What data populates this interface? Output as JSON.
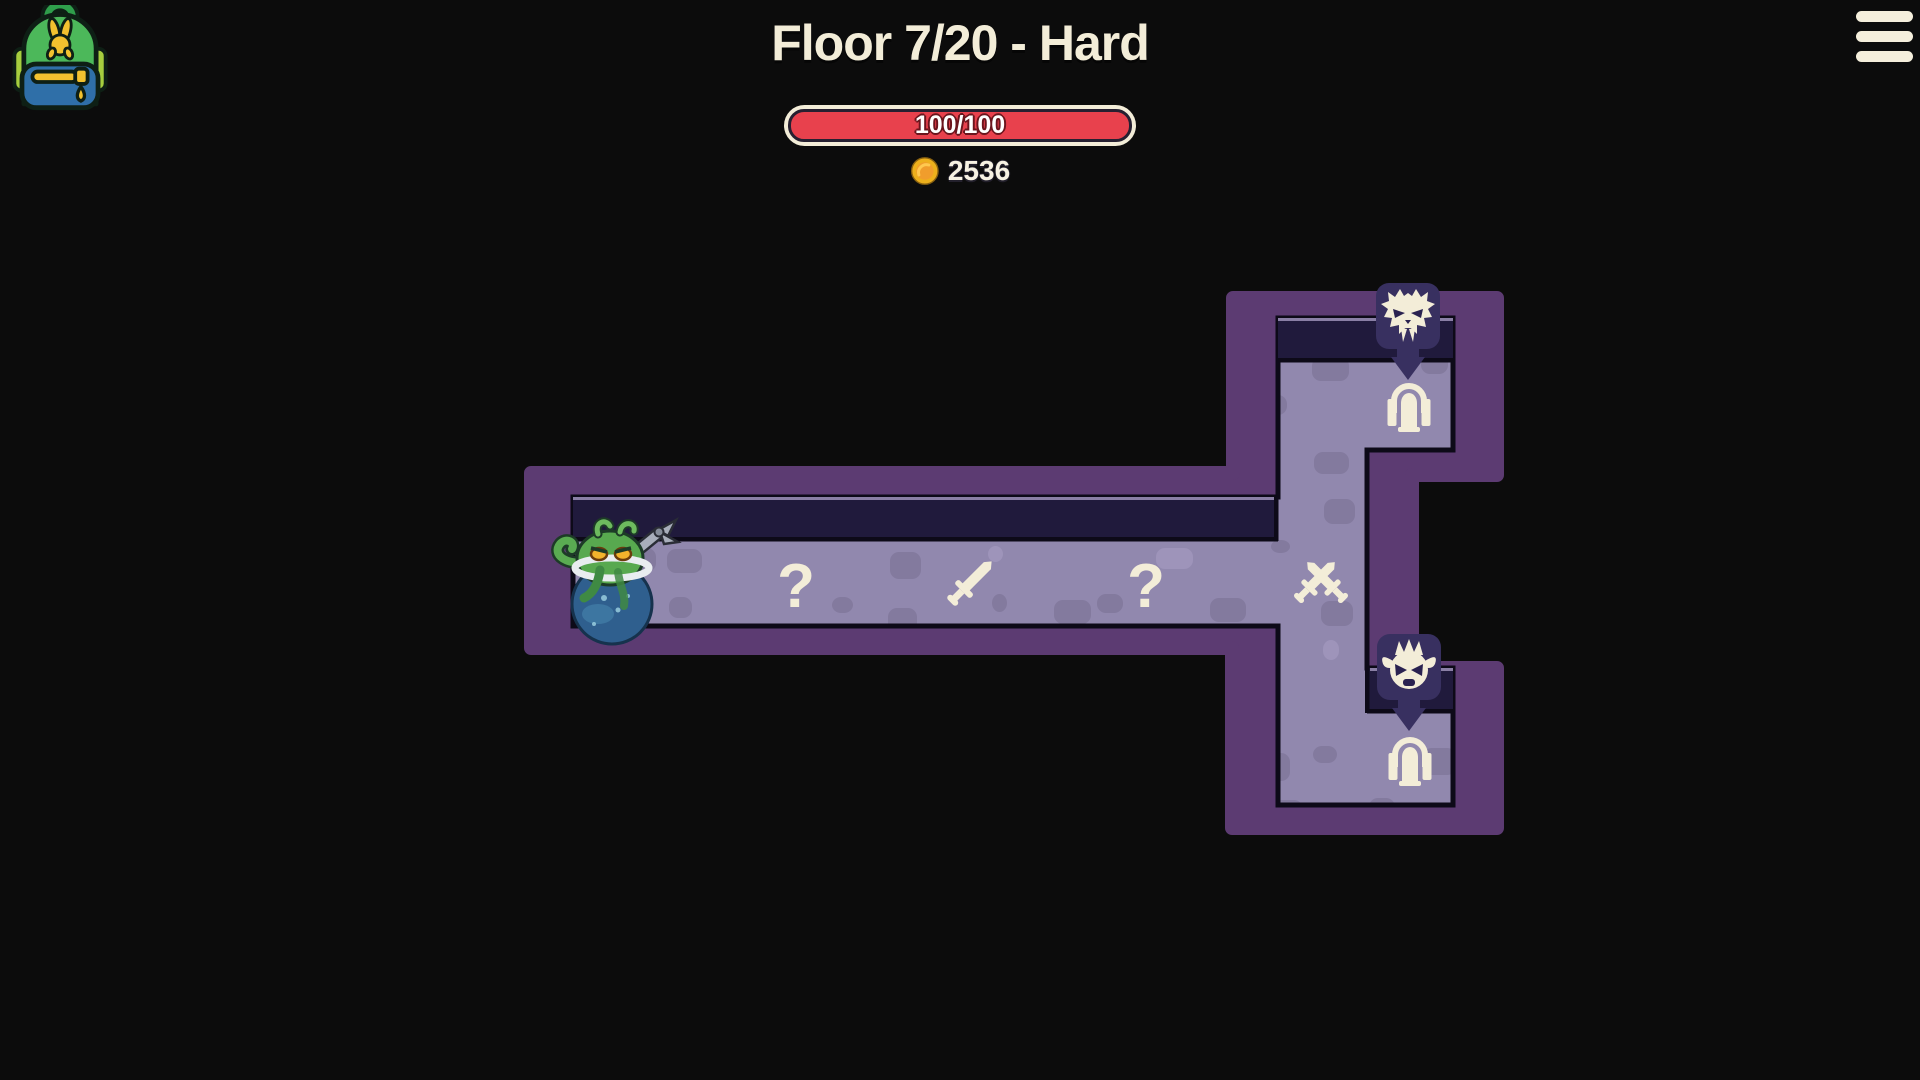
{
  "header": {
    "title": "Floor 7/20 - Hard",
    "health": {
      "current": 100,
      "max": 100,
      "display": "100/100"
    },
    "gold": "2536"
  },
  "hud": {
    "inventory_icon": "backpack-icon",
    "menu_icon": "hamburger-menu-icon",
    "coin_icon": "gold-coin-icon"
  },
  "colors": {
    "background": "#0c0c0c",
    "wall": "#5c3b72",
    "floor": "#9188ae",
    "tile_dark": "#837a9e",
    "tile_light": "#9e94ba",
    "wall_top": "#201a3c",
    "wall_top_highlight": "#8a7fa5",
    "outline": "#0d0a18",
    "cream": "#f3edd8",
    "badge": "#383060",
    "health_red": "#e8414d",
    "coin_gold": "#edb01c",
    "coin_inner": "#f09d2c"
  },
  "map": {
    "nodes": [
      {
        "name": "player-character",
        "icon": "octopus-clawbot",
        "type": "player",
        "x": 612,
        "y": 584
      },
      {
        "name": "node-unknown-1",
        "icon": "question-mark",
        "type": "unknown",
        "x": 796,
        "y": 585
      },
      {
        "name": "node-item-sword",
        "icon": "sword",
        "type": "item",
        "x": 969,
        "y": 584
      },
      {
        "name": "node-unknown-2",
        "icon": "question-mark",
        "type": "unknown",
        "x": 1146,
        "y": 585
      },
      {
        "name": "node-battle",
        "icon": "crossed-swords",
        "type": "battle",
        "x": 1321,
        "y": 583
      },
      {
        "name": "exit-door-top",
        "icon": "door",
        "type": "exit",
        "x": 1409,
        "y": 403,
        "badge": {
          "icon": "horned-beast-face",
          "x": 1408,
          "y": 316
        }
      },
      {
        "name": "exit-door-bottom",
        "icon": "door",
        "type": "exit",
        "x": 1410,
        "y": 757,
        "badge": {
          "icon": "spiky-imp-face",
          "x": 1409,
          "y": 667
        }
      }
    ]
  }
}
